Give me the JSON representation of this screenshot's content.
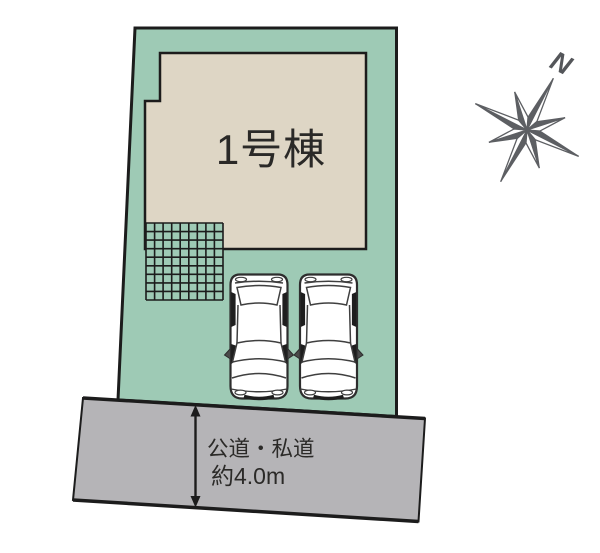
{
  "site_plan": {
    "building": {
      "label": "1号棟"
    },
    "road": {
      "type_label": "公道・私道",
      "width_label": "約4.0m"
    },
    "compass": {
      "north_label": "N"
    },
    "parking": {
      "car_count": 2
    },
    "colors": {
      "plot_green": "#9ecab5",
      "building_beige": "#ded6c5",
      "road_gray": "#b5b4b7",
      "outline_dark": "#1c1c1c",
      "compass_gray": "#5d5f63"
    }
  }
}
